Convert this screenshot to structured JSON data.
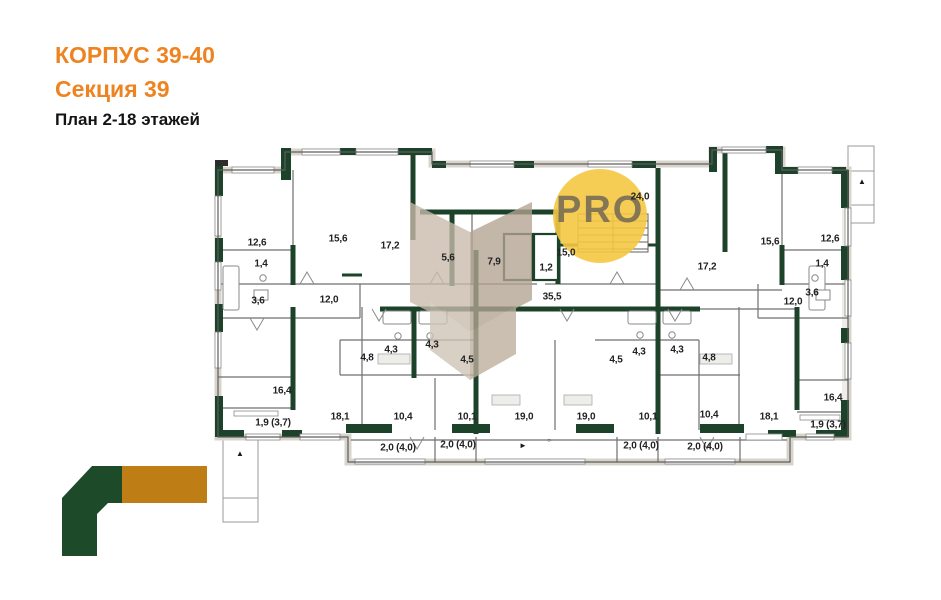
{
  "header": {
    "building": "КОРПУС 39-40",
    "section": "Секция 39",
    "plan": "План 2-18 этажей"
  },
  "watermark": {
    "text": "PRO",
    "circle_color": "#f5c841",
    "text_color": "#6a6154",
    "facet_colors": [
      "#c8bbaa",
      "#b3a392",
      "#cfc4b6",
      "#bdae9c"
    ]
  },
  "logo": {
    "green_color": "#1d4a28",
    "orange_color": "#bf7d16"
  },
  "colors": {
    "wall_green": "#1c432a",
    "thin_line": "#6f6f6f",
    "title_orange": "#ee8421"
  },
  "plan": {
    "rooms": [
      {
        "label": "12,6",
        "x": 257,
        "y": 243
      },
      {
        "label": "15,6",
        "x": 338,
        "y": 239
      },
      {
        "label": "17,2",
        "x": 390,
        "y": 246
      },
      {
        "label": "1,4",
        "x": 261,
        "y": 264
      },
      {
        "label": "3,6",
        "x": 258,
        "y": 301
      },
      {
        "label": "12,0",
        "x": 329,
        "y": 300
      },
      {
        "label": "5,6",
        "x": 448,
        "y": 258
      },
      {
        "label": "7,9",
        "x": 494,
        "y": 262
      },
      {
        "label": "1,2",
        "x": 546,
        "y": 268
      },
      {
        "label": "15,0",
        "x": 566,
        "y": 253
      },
      {
        "label": "24,0",
        "x": 640,
        "y": 197
      },
      {
        "label": "35,5",
        "x": 552,
        "y": 297
      },
      {
        "label": "17,2",
        "x": 707,
        "y": 267
      },
      {
        "label": "15,6",
        "x": 770,
        "y": 242
      },
      {
        "label": "12,6",
        "x": 830,
        "y": 239
      },
      {
        "label": "1,4",
        "x": 822,
        "y": 264
      },
      {
        "label": "3,6",
        "x": 812,
        "y": 293
      },
      {
        "label": "12,0",
        "x": 793,
        "y": 302
      },
      {
        "label": "16,4",
        "x": 282,
        "y": 391
      },
      {
        "label": "1,9 (3,7)",
        "x": 273,
        "y": 423
      },
      {
        "label": "18,1",
        "x": 340,
        "y": 417
      },
      {
        "label": "10,4",
        "x": 403,
        "y": 417
      },
      {
        "label": "4,8",
        "x": 367,
        "y": 358
      },
      {
        "label": "4,3",
        "x": 391,
        "y": 350
      },
      {
        "label": "4,3",
        "x": 432,
        "y": 345
      },
      {
        "label": "4,5",
        "x": 467,
        "y": 360
      },
      {
        "label": "10,1",
        "x": 467,
        "y": 417
      },
      {
        "label": "19,0",
        "x": 524,
        "y": 417
      },
      {
        "label": "19,0",
        "x": 586,
        "y": 417
      },
      {
        "label": "10,1",
        "x": 648,
        "y": 417
      },
      {
        "label": "4,5",
        "x": 616,
        "y": 360
      },
      {
        "label": "4,3",
        "x": 639,
        "y": 352
      },
      {
        "label": "4,3",
        "x": 677,
        "y": 350
      },
      {
        "label": "4,8",
        "x": 709,
        "y": 358
      },
      {
        "label": "10,4",
        "x": 709,
        "y": 415
      },
      {
        "label": "18,1",
        "x": 769,
        "y": 417
      },
      {
        "label": "16,4",
        "x": 833,
        "y": 398
      },
      {
        "label": "1,9 (3,7)",
        "x": 828,
        "y": 425
      },
      {
        "label": "2,0 (4,0)",
        "x": 398,
        "y": 448
      },
      {
        "label": "2,0 (4,0)",
        "x": 458,
        "y": 445
      },
      {
        "label": "2,0 (4,0)",
        "x": 641,
        "y": 446
      },
      {
        "label": "2,0 (4,0)",
        "x": 705,
        "y": 447
      }
    ],
    "markers": [
      {
        "glyph": "▲",
        "x": 240,
        "y": 454,
        "name": "triangle-marker"
      },
      {
        "glyph": "▲",
        "x": 862,
        "y": 182,
        "name": "triangle-marker"
      },
      {
        "glyph": "►",
        "x": 523,
        "y": 446,
        "name": "arrow-marker"
      },
      {
        "glyph": "○",
        "x": 549,
        "y": 441,
        "name": "circle-marker"
      }
    ]
  }
}
